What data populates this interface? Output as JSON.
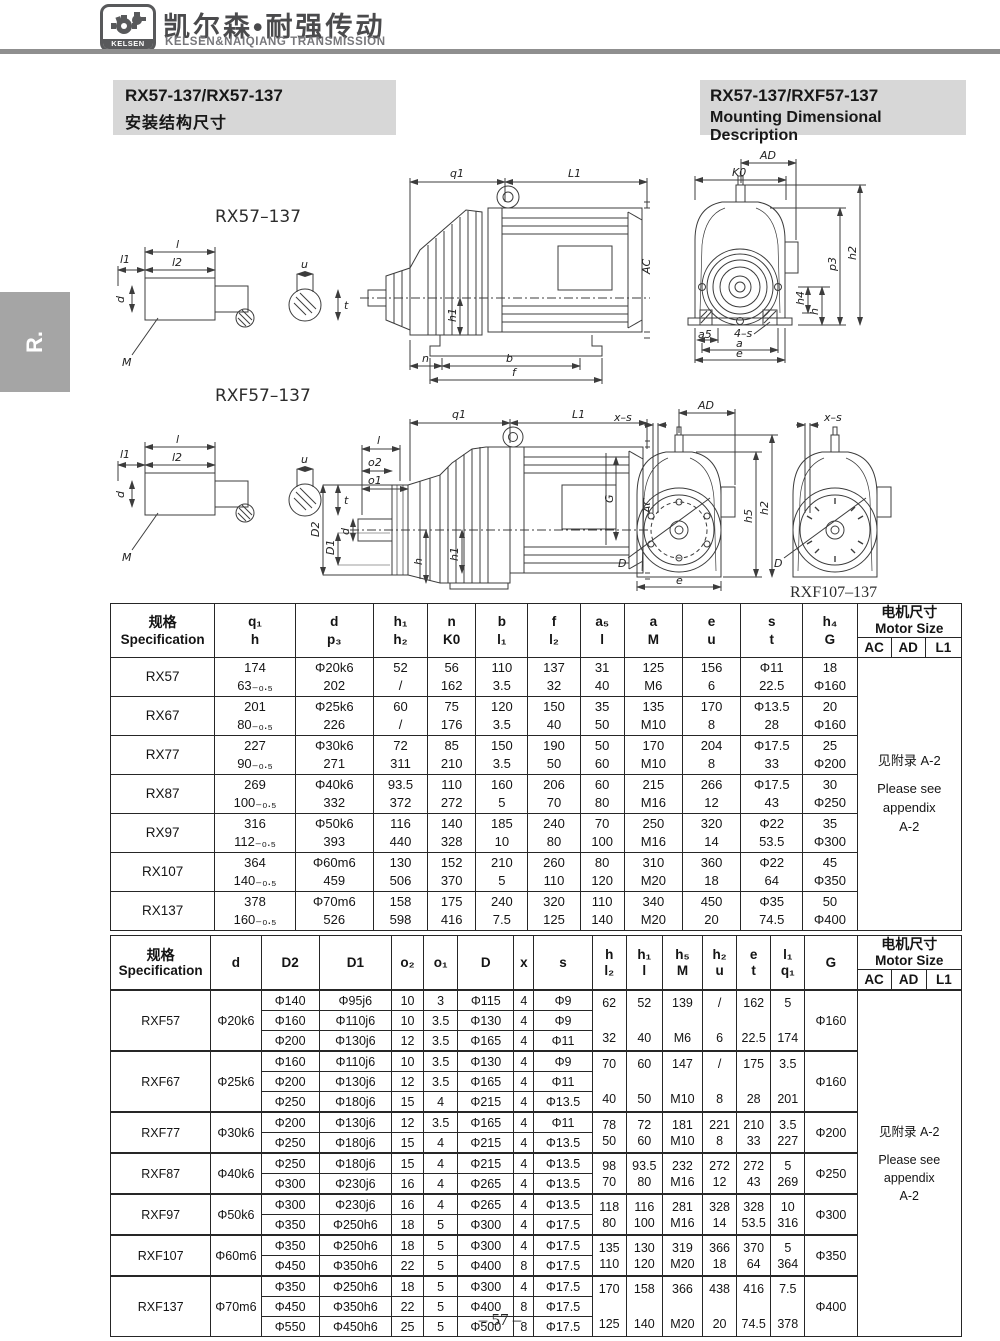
{
  "brand": {
    "logo_text": "KELSEN",
    "title_cn": "凯尔森•耐强传动",
    "title_en": "KELSEN&NAIQIANG TRANSMISSION"
  },
  "side_tab": "R.",
  "titles": {
    "left1": "RX57-137/RX57-137",
    "left2": "安装结构尺寸",
    "right1": "RX57-137/RXF57-137",
    "right2": "Mounting Dimensional Description"
  },
  "page_number": "– 57 –",
  "drawings": {
    "rx_label": "RX57–137",
    "rxf_label": "RXF57–137",
    "rxf107_label": "RXF107–137",
    "dims": {
      "q1": "q1",
      "L1": "L1",
      "AC": "AC",
      "G": "G",
      "h1": "h1",
      "n": "n",
      "b": "b",
      "f": "f",
      "l": "l",
      "l1": "l1",
      "l2": "l2",
      "u": "u",
      "d": "d",
      "t": "t",
      "M": "M",
      "AD": "AD",
      "K0": "K0",
      "p3": "p3",
      "h2": "h2",
      "h4": "h4",
      "h": "h",
      "a5": "a5",
      "s4": "4–s",
      "a": "a",
      "e": "e",
      "o1": "o1",
      "o2": "o2",
      "D1": "D1",
      "D2": "D2",
      "xs": "x–s",
      "h5": "h5",
      "D": "D"
    }
  },
  "table1": {
    "spec_header": [
      "规格",
      "Specification"
    ],
    "cols": [
      [
        "q₁",
        "h"
      ],
      [
        "d",
        "p₃"
      ],
      [
        "h₁",
        "h₂"
      ],
      [
        "n",
        "K0"
      ],
      [
        "b",
        "l₁"
      ],
      [
        "f",
        "l₂"
      ],
      [
        "a₅",
        "l"
      ],
      [
        "a",
        "M"
      ],
      [
        "e",
        "u"
      ],
      [
        "s",
        "t"
      ],
      [
        "h₄",
        "G"
      ]
    ],
    "motor": {
      "cn": "电机尺寸",
      "en": "Motor Size",
      "subs": [
        "AC",
        "AD",
        "L1"
      ]
    },
    "note": [
      "见附录 A-2",
      "Please see",
      "appendix",
      "A-2"
    ],
    "rows": [
      {
        "spec": "RX57",
        "cells": [
          [
            "174",
            "63₋₀.₅"
          ],
          [
            "Φ20k6",
            "202"
          ],
          [
            "52",
            "/"
          ],
          [
            "56",
            "162"
          ],
          [
            "110",
            "3.5"
          ],
          [
            "137",
            "32"
          ],
          [
            "31",
            "40"
          ],
          [
            "125",
            "M6"
          ],
          [
            "156",
            "6"
          ],
          [
            "Φ11",
            "22.5"
          ],
          [
            "18",
            "Φ160"
          ]
        ]
      },
      {
        "spec": "RX67",
        "cells": [
          [
            "201",
            "80₋₀.₅"
          ],
          [
            "Φ25k6",
            "226"
          ],
          [
            "60",
            "/"
          ],
          [
            "75",
            "176"
          ],
          [
            "120",
            "3.5"
          ],
          [
            "150",
            "40"
          ],
          [
            "35",
            "50"
          ],
          [
            "135",
            "M10"
          ],
          [
            "170",
            "8"
          ],
          [
            "Φ13.5",
            "28"
          ],
          [
            "20",
            "Φ160"
          ]
        ]
      },
      {
        "spec": "RX77",
        "cells": [
          [
            "227",
            "90₋₀.₅"
          ],
          [
            "Φ30k6",
            "271"
          ],
          [
            "72",
            "311"
          ],
          [
            "85",
            "210"
          ],
          [
            "150",
            "3.5"
          ],
          [
            "190",
            "50"
          ],
          [
            "50",
            "60"
          ],
          [
            "170",
            "M10"
          ],
          [
            "204",
            "8"
          ],
          [
            "Φ17.5",
            "33"
          ],
          [
            "25",
            "Φ200"
          ]
        ]
      },
      {
        "spec": "RX87",
        "cells": [
          [
            "269",
            "100₋₀.₅"
          ],
          [
            "Φ40k6",
            "332"
          ],
          [
            "93.5",
            "372"
          ],
          [
            "110",
            "272"
          ],
          [
            "160",
            "5"
          ],
          [
            "206",
            "70"
          ],
          [
            "60",
            "80"
          ],
          [
            "215",
            "M16"
          ],
          [
            "266",
            "12"
          ],
          [
            "Φ17.5",
            "43"
          ],
          [
            "30",
            "Φ250"
          ]
        ]
      },
      {
        "spec": "RX97",
        "cells": [
          [
            "316",
            "112₋₀.₅"
          ],
          [
            "Φ50k6",
            "393"
          ],
          [
            "116",
            "440"
          ],
          [
            "140",
            "328"
          ],
          [
            "185",
            "10"
          ],
          [
            "240",
            "80"
          ],
          [
            "70",
            "100"
          ],
          [
            "250",
            "M16"
          ],
          [
            "320",
            "14"
          ],
          [
            "Φ22",
            "53.5"
          ],
          [
            "35",
            "Φ300"
          ]
        ]
      },
      {
        "spec": "RX107",
        "cells": [
          [
            "364",
            "140₋₀.₅"
          ],
          [
            "Φ60m6",
            "459"
          ],
          [
            "130",
            "506"
          ],
          [
            "152",
            "370"
          ],
          [
            "210",
            "5"
          ],
          [
            "260",
            "110"
          ],
          [
            "80",
            "120"
          ],
          [
            "310",
            "M20"
          ],
          [
            "360",
            "18"
          ],
          [
            "Φ22",
            "64"
          ],
          [
            "45",
            "Φ350"
          ]
        ]
      },
      {
        "spec": "RX137",
        "cells": [
          [
            "378",
            "160₋₀.₅"
          ],
          [
            "Φ70m6",
            "526"
          ],
          [
            "158",
            "598"
          ],
          [
            "175",
            "416"
          ],
          [
            "240",
            "7.5"
          ],
          [
            "320",
            "125"
          ],
          [
            "110",
            "140"
          ],
          [
            "340",
            "M20"
          ],
          [
            "450",
            "20"
          ],
          [
            "Φ35",
            "74.5"
          ],
          [
            "50",
            "Φ400"
          ]
        ]
      }
    ]
  },
  "table2": {
    "spec_header": [
      "规格",
      "Specification"
    ],
    "cols": [
      [
        "d"
      ],
      [
        "D2"
      ],
      [
        "D1"
      ],
      [
        "o₂"
      ],
      [
        "o₁"
      ],
      [
        "D"
      ],
      [
        "x"
      ],
      [
        "s"
      ],
      [
        "h",
        "l₂"
      ],
      [
        "h₁",
        "l"
      ],
      [
        "h₅",
        "M"
      ],
      [
        "h₂",
        "u"
      ],
      [
        "e",
        "t"
      ],
      [
        "l₁",
        "q₁"
      ],
      [
        "G"
      ]
    ],
    "motor": {
      "cn": "电机尺寸",
      "en": "Motor Size",
      "subs": [
        "AC",
        "AD",
        "L1"
      ]
    },
    "note": [
      "见附录 A-2",
      "Please see",
      "appendix",
      "A-2"
    ],
    "groups": [
      {
        "spec": "RXF57",
        "d": "Φ20k6",
        "G": "Φ160",
        "subrows": [
          [
            "Φ140",
            "Φ95j6",
            "10",
            "3",
            "Φ115",
            "4",
            "Φ9"
          ],
          [
            "Φ160",
            "Φ110j6",
            "10",
            "3.5",
            "Φ130",
            "4",
            "Φ9"
          ],
          [
            "Φ200",
            "Φ130j6",
            "12",
            "3.5",
            "Φ165",
            "4",
            "Φ11"
          ]
        ],
        "bands": [
          [
            "62",
            "32"
          ],
          [
            "52",
            "40"
          ],
          [
            "139",
            "M6"
          ],
          [
            "/",
            "6"
          ],
          [
            "162",
            "22.5"
          ],
          [
            "5",
            "174"
          ]
        ]
      },
      {
        "spec": "RXF67",
        "d": "Φ25k6",
        "G": "Φ160",
        "subrows": [
          [
            "Φ160",
            "Φ110j6",
            "10",
            "3.5",
            "Φ130",
            "4",
            "Φ9"
          ],
          [
            "Φ200",
            "Φ130j6",
            "12",
            "3.5",
            "Φ165",
            "4",
            "Φ11"
          ],
          [
            "Φ250",
            "Φ180j6",
            "15",
            "4",
            "Φ215",
            "4",
            "Φ13.5"
          ]
        ],
        "bands": [
          [
            "70",
            "40"
          ],
          [
            "60",
            "50"
          ],
          [
            "147",
            "M10"
          ],
          [
            "/",
            "8"
          ],
          [
            "175",
            "28"
          ],
          [
            "3.5",
            "201"
          ]
        ]
      },
      {
        "spec": "RXF77",
        "d": "Φ30k6",
        "G": "Φ200",
        "subrows": [
          [
            "Φ200",
            "Φ130j6",
            "12",
            "3.5",
            "Φ165",
            "4",
            "Φ11"
          ],
          [
            "Φ250",
            "Φ180j6",
            "15",
            "4",
            "Φ215",
            "4",
            "Φ13.5"
          ]
        ],
        "bands": [
          [
            "78",
            "50"
          ],
          [
            "72",
            "60"
          ],
          [
            "181",
            "M10"
          ],
          [
            "221",
            "8"
          ],
          [
            "210",
            "33"
          ],
          [
            "3.5",
            "227"
          ]
        ]
      },
      {
        "spec": "RXF87",
        "d": "Φ40k6",
        "G": "Φ250",
        "subrows": [
          [
            "Φ250",
            "Φ180j6",
            "15",
            "4",
            "Φ215",
            "4",
            "Φ13.5"
          ],
          [
            "Φ300",
            "Φ230j6",
            "16",
            "4",
            "Φ265",
            "4",
            "Φ13.5"
          ]
        ],
        "bands": [
          [
            "98",
            "70"
          ],
          [
            "93.5",
            "80"
          ],
          [
            "232",
            "M16"
          ],
          [
            "272",
            "12"
          ],
          [
            "272",
            "43"
          ],
          [
            "5",
            "269"
          ]
        ]
      },
      {
        "spec": "RXF97",
        "d": "Φ50k6",
        "G": "Φ300",
        "subrows": [
          [
            "Φ300",
            "Φ230j6",
            "16",
            "4",
            "Φ265",
            "4",
            "Φ13.5"
          ],
          [
            "Φ350",
            "Φ250h6",
            "18",
            "5",
            "Φ300",
            "4",
            "Φ17.5"
          ]
        ],
        "bands": [
          [
            "118",
            "80"
          ],
          [
            "116",
            "100"
          ],
          [
            "281",
            "M16"
          ],
          [
            "328",
            "14"
          ],
          [
            "328",
            "53.5"
          ],
          [
            "10",
            "316"
          ]
        ]
      },
      {
        "spec": "RXF107",
        "d": "Φ60m6",
        "G": "Φ350",
        "subrows": [
          [
            "Φ350",
            "Φ250h6",
            "18",
            "5",
            "Φ300",
            "4",
            "Φ17.5"
          ],
          [
            "Φ450",
            "Φ350h6",
            "22",
            "5",
            "Φ400",
            "8",
            "Φ17.5"
          ]
        ],
        "bands": [
          [
            "135",
            "110"
          ],
          [
            "130",
            "120"
          ],
          [
            "319",
            "M20"
          ],
          [
            "366",
            "18"
          ],
          [
            "370",
            "64"
          ],
          [
            "5",
            "364"
          ]
        ]
      },
      {
        "spec": "RXF137",
        "d": "Φ70m6",
        "G": "Φ400",
        "subrows": [
          [
            "Φ350",
            "Φ250h6",
            "18",
            "5",
            "Φ300",
            "4",
            "Φ17.5"
          ],
          [
            "Φ450",
            "Φ350h6",
            "22",
            "5",
            "Φ400",
            "8",
            "Φ17.5"
          ],
          [
            "Φ550",
            "Φ450h6",
            "25",
            "5",
            "Φ500",
            "8",
            "Φ17.5"
          ]
        ],
        "bands": [
          [
            "170",
            "125"
          ],
          [
            "158",
            "140"
          ],
          [
            "366",
            "M20"
          ],
          [
            "438",
            "20"
          ],
          [
            "416",
            "74.5"
          ],
          [
            "7.5",
            "378"
          ]
        ]
      }
    ]
  }
}
